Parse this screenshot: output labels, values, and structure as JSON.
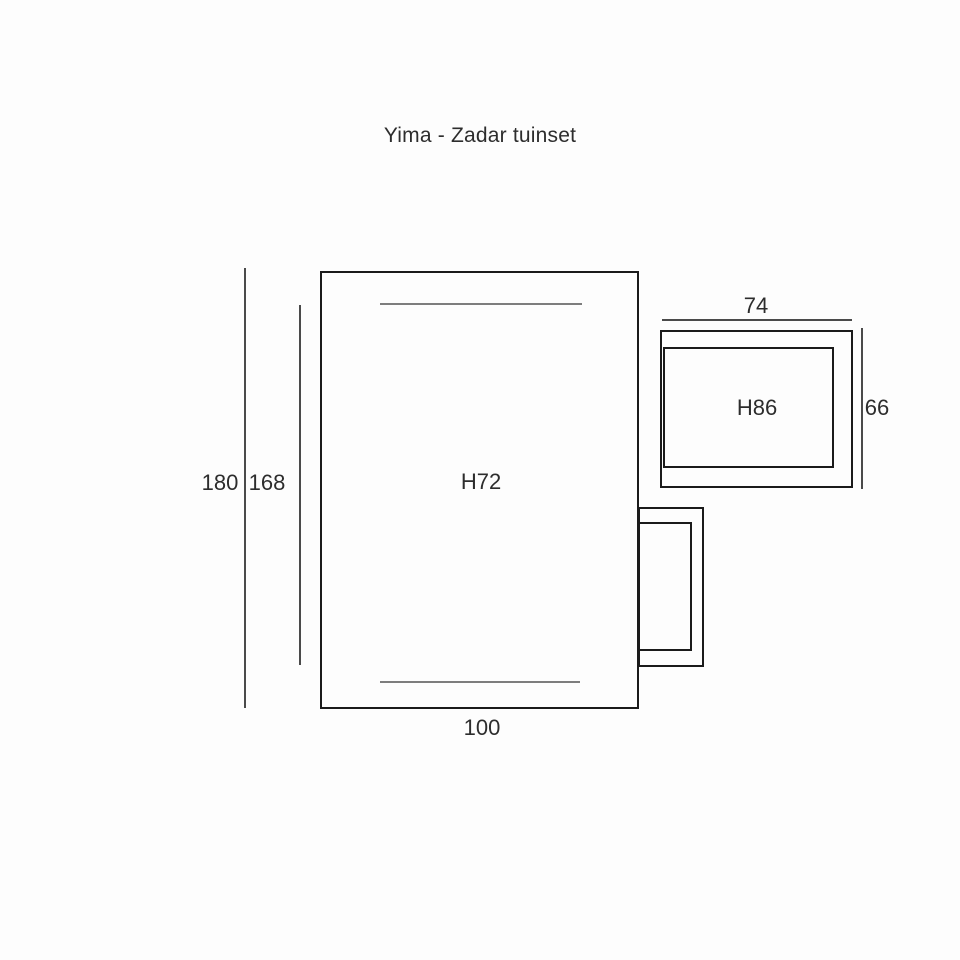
{
  "title": "Yima - Zadar tuinset",
  "diagram": {
    "table": {
      "label": "H72",
      "outer_height": "180",
      "inner_height": "168",
      "width": "100"
    },
    "chair": {
      "label": "H86",
      "width": "74",
      "height": "66"
    }
  },
  "colors": {
    "background": "#fdfdfd",
    "outline": "#1b1b1b",
    "dimension_line": "#4a4a4a",
    "detail_line": "#7d7d7d",
    "text": "#2d2d2d"
  }
}
